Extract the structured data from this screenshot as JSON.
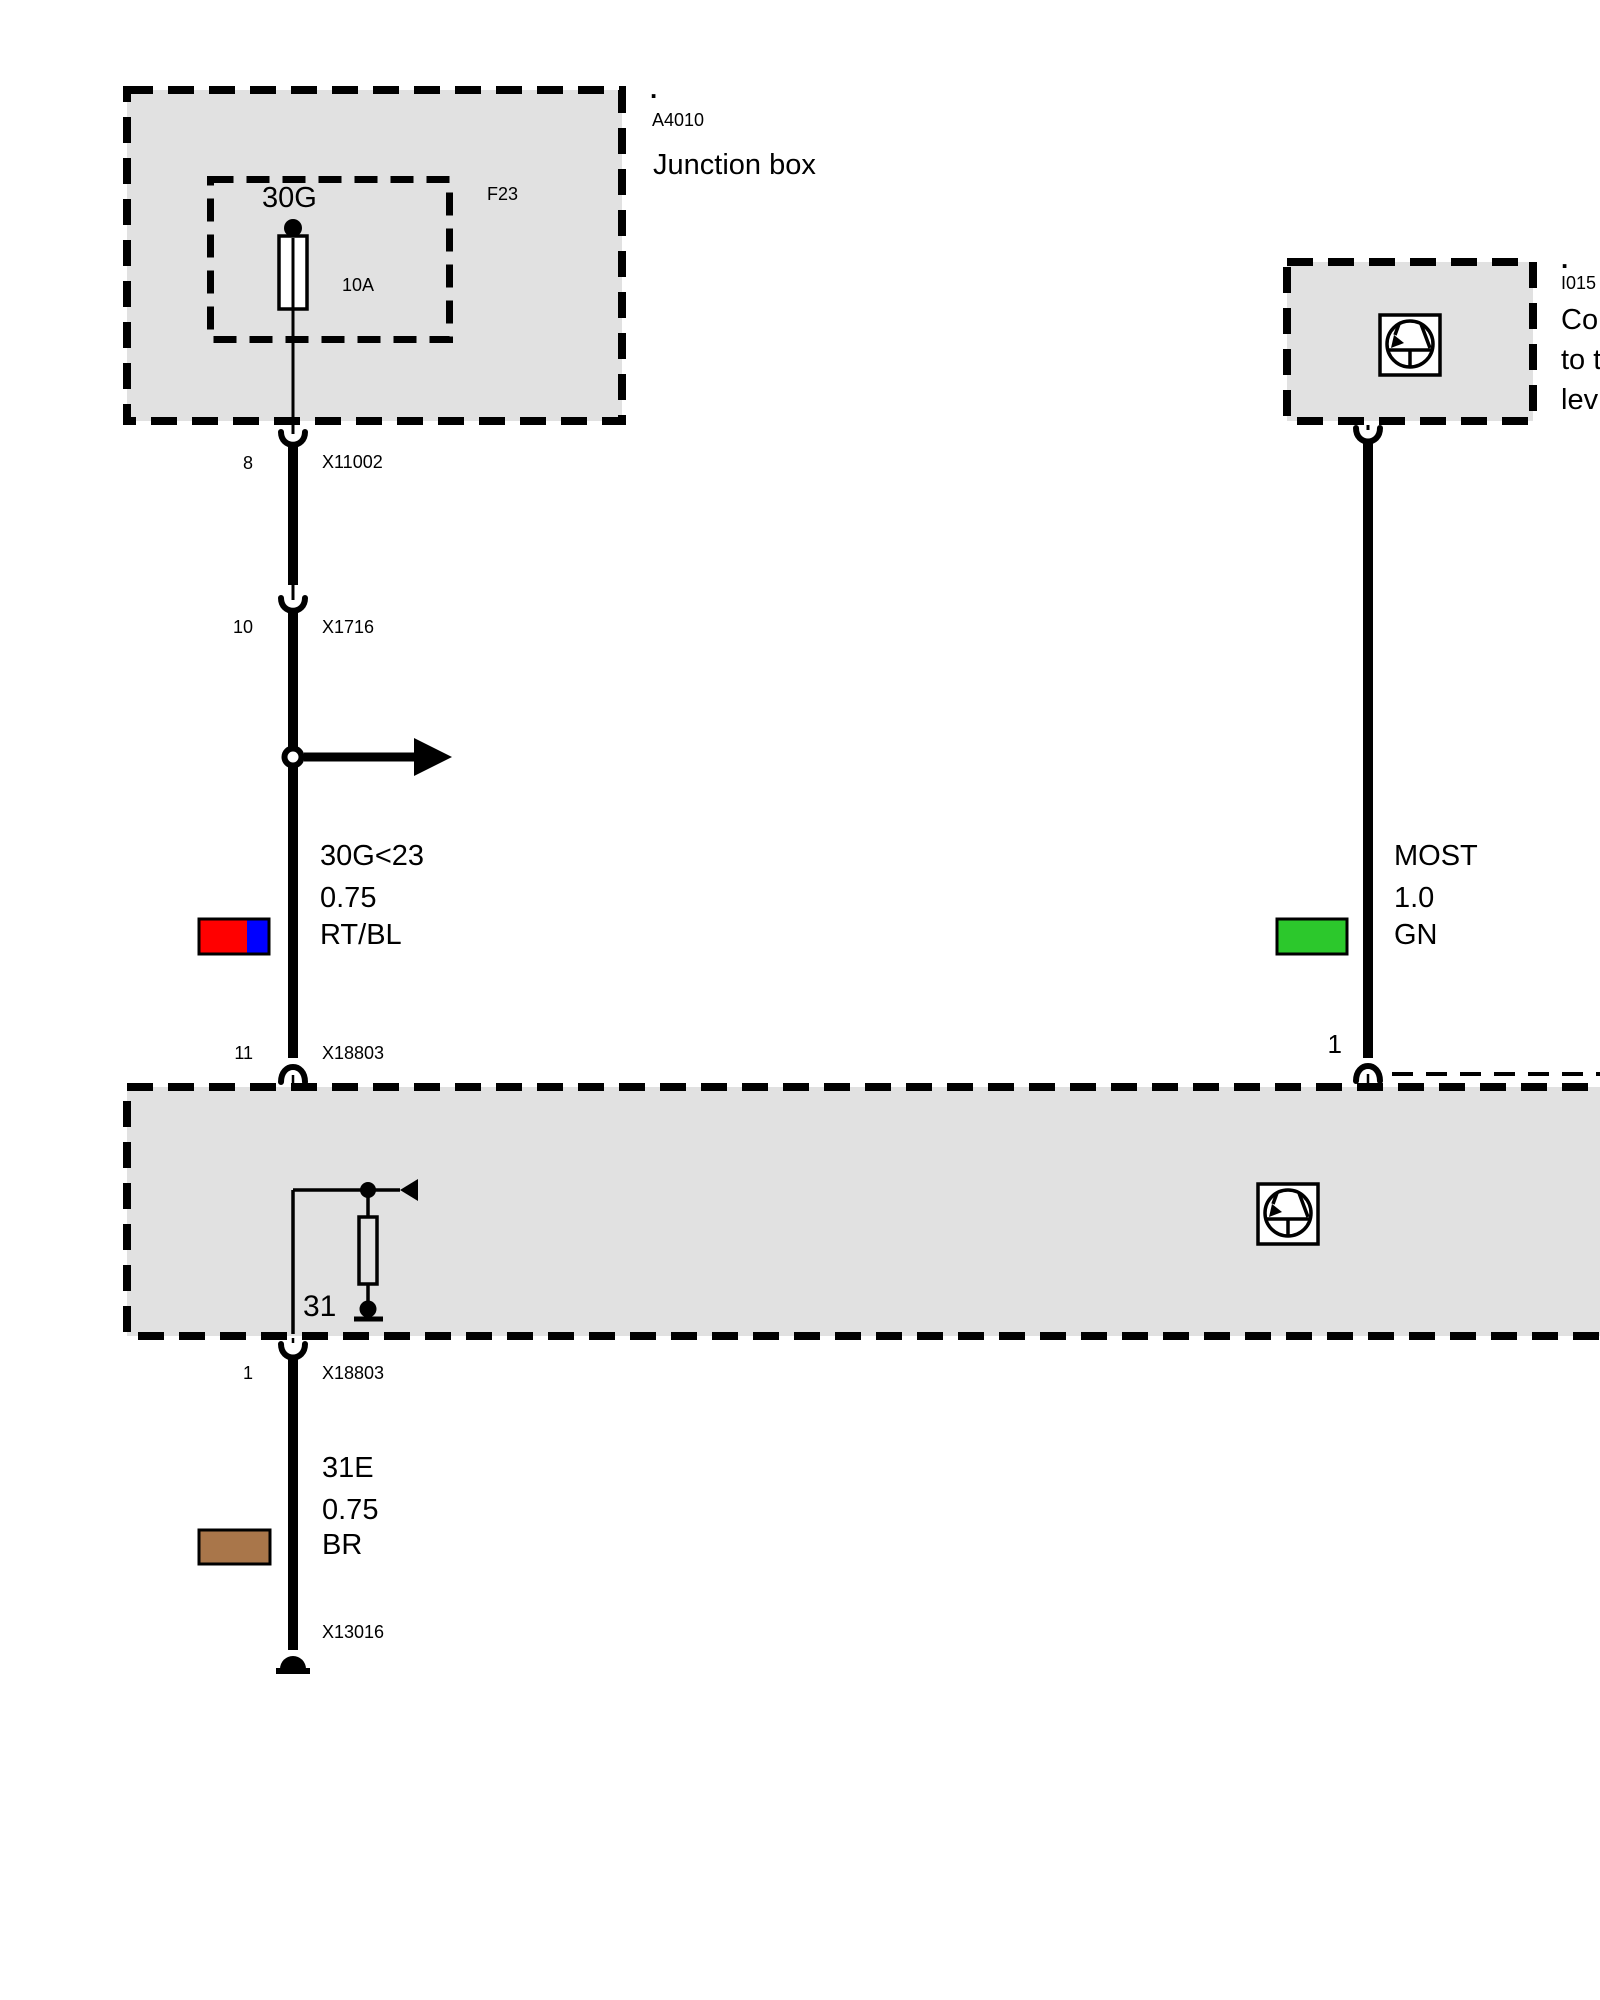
{
  "diagram": {
    "junction_box": {
      "marker": ".",
      "code": "A4010",
      "title": "Junction box",
      "fuse": {
        "circuit": "30G",
        "name": "F23",
        "rating": "10A"
      }
    },
    "right_module": {
      "marker": ".",
      "code": "I015",
      "desc_line1": "Co",
      "desc_line2": "to t",
      "desc_line3": "lev"
    },
    "connectors": {
      "c1": {
        "pin": "8",
        "id": "X11002"
      },
      "c2": {
        "pin": "10",
        "id": "X1716"
      },
      "c3": {
        "pin": "11",
        "id": "X18803"
      },
      "right_pin": "1",
      "c4": {
        "pin": "1",
        "id": "X18803"
      },
      "c5": {
        "id": "X13016"
      }
    },
    "wires": {
      "left": {
        "circuit": "30G<23",
        "gauge": "0.75",
        "color": "RT/BL"
      },
      "right": {
        "circuit": "MOST",
        "gauge": "1.0",
        "color": "GN"
      },
      "bottom": {
        "circuit": "31E",
        "gauge": "0.75",
        "color": "BR"
      }
    },
    "bottom_module": {
      "ground": "31"
    }
  },
  "colors": {
    "module_fill": "#E1E1E1",
    "line": "#000000",
    "wire_red": "#FF0000",
    "wire_blue": "#0000FF",
    "wire_green": "#2CC82C",
    "wire_brown": "#A9764A",
    "icon_fill": "#FFFFFF"
  }
}
